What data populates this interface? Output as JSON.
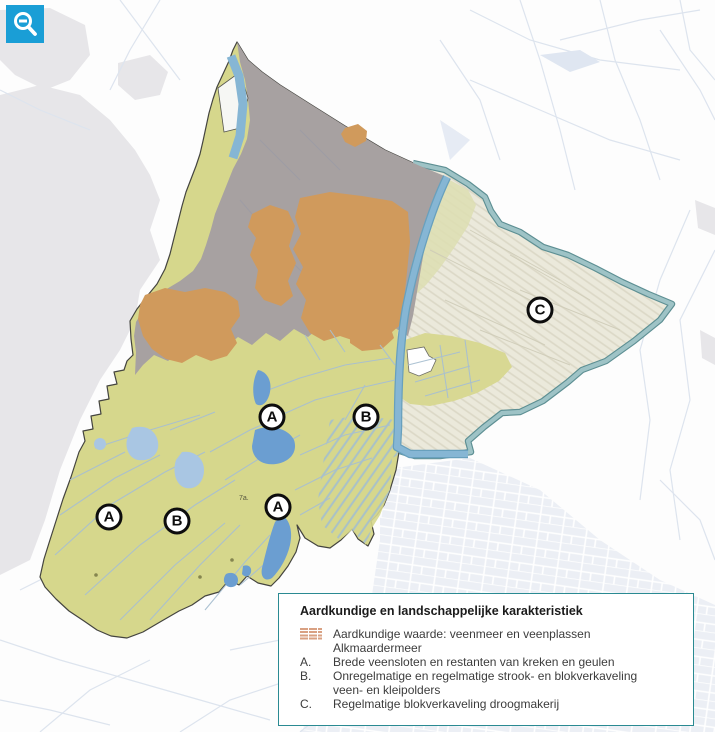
{
  "controls": {
    "zoom_out_icon": "magnifier-minus"
  },
  "map": {
    "markers": [
      {
        "label": "A"
      },
      {
        "label": "B"
      },
      {
        "label": "C"
      },
      {
        "label": "A"
      },
      {
        "label": "B"
      },
      {
        "label": "A"
      }
    ],
    "tiny_label": "7a."
  },
  "legend": {
    "title": "Aardkundige en landschappelijke karakteristiek",
    "items": [
      {
        "key": "",
        "line1": "Aardkundige waarde: veenmeer en veenplassen",
        "line2": "Alkmaardermeer"
      },
      {
        "key": "A.",
        "line1": "Brede veensloten en restanten van kreken en geulen"
      },
      {
        "key": "B.",
        "line1": "Onregelmatige en regelmatige strook- en blokverkaveling",
        "line2": "veen- en kleipolders"
      },
      {
        "key": "C.",
        "line1": "Regelmatige blokverkaveling droogmakerij"
      }
    ]
  },
  "colors": {
    "khaki": "#d6d78c",
    "urban_gray": "#a7a1a1",
    "orange": "#d09a5c",
    "cream": "#ebe9db",
    "water_dark": "#6b9ed1",
    "water_light": "#a9c6e3",
    "canal_blue": "#86b6d4",
    "ring_teal": "#9ec3c6",
    "ring_edge": "#5d8f93",
    "ditch": "#a8bfd0",
    "outside_gray": "#e7e6e9",
    "outside_line": "#dde4ee",
    "boundary": "#44443f",
    "legend_border": "#2a8a92",
    "button_blue": "#1a9ed6",
    "swatch": "#d9a183"
  }
}
